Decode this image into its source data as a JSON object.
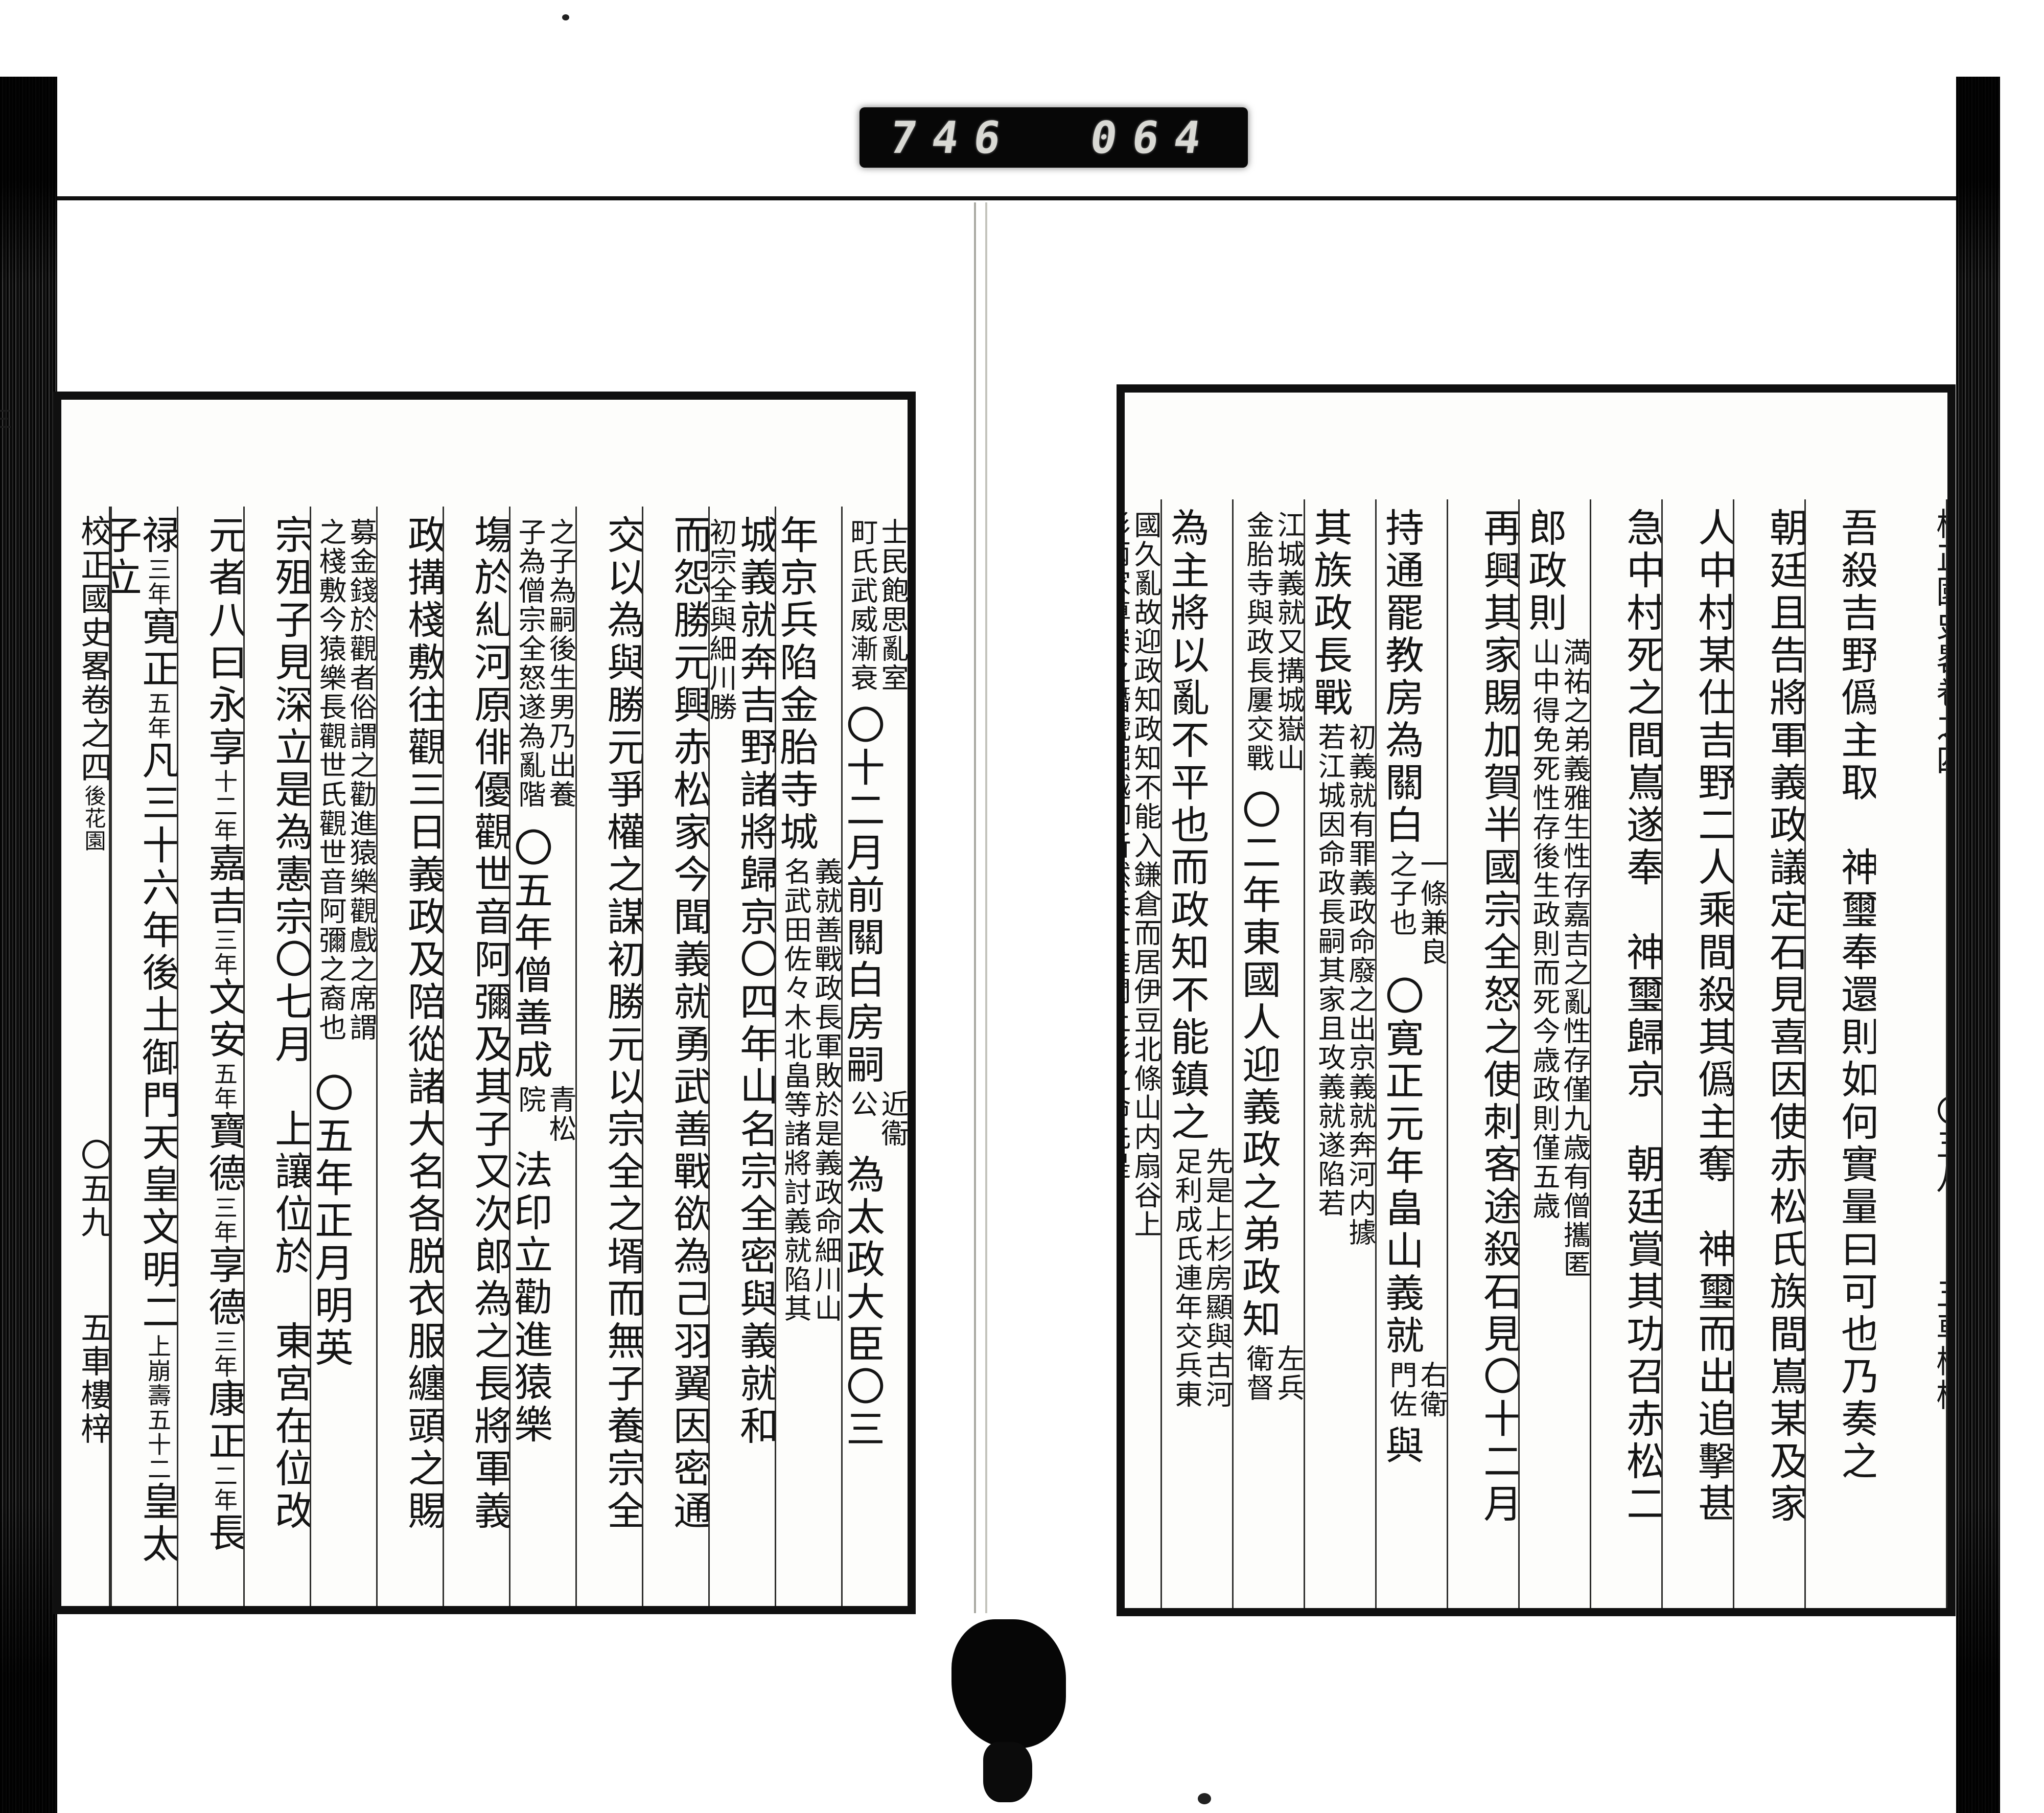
{
  "scanner_counter": {
    "left_digits": "746",
    "right_digits": "064"
  },
  "book_title": "校正國史畧卷之四",
  "right_page": {
    "headers": [
      {
        "lines": [
          "赤松氏",
          "家至是",
          "可興"
        ],
        "offset": 620
      },
      {
        "lines": [
          "寛正元",
          "年"
        ],
        "offset": 990
      },
      {
        "lines": [
          "二",
          "年"
        ],
        "offset": 1300
      }
    ],
    "columns": [
      {
        "gutter": true,
        "clipped": true,
        "segments": [
          {
            "type": "main",
            "text": "校正國史畧卷之四"
          },
          {
            "type": "gap",
            "px": 620
          },
          {
            "type": "main",
            "text": "〇五八"
          },
          {
            "type": "gap",
            "px": 160
          },
          {
            "type": "main",
            "text": "五車樓梓"
          }
        ]
      },
      {
        "segments": [
          {
            "type": "main",
            "text": "吾殺吉野僞主取　神璽奉還則如何實量曰可也乃奏之"
          }
        ]
      },
      {
        "segments": [
          {
            "type": "main",
            "text": "朝廷且告將軍義政議定石見喜因使赤松氏族間嶌某及家"
          }
        ]
      },
      {
        "segments": [
          {
            "type": "main",
            "text": "人中村某仕吉野二人乘間殺其僞主奪　神璽而出追擊甚"
          }
        ]
      },
      {
        "segments": [
          {
            "type": "main",
            "text": "急中村死之間嶌遂奉　神璽歸京　朝廷賞其功召赤松二"
          }
        ]
      },
      {
        "segments": [
          {
            "type": "main",
            "text": "郎政則"
          },
          {
            "type": "note",
            "text": "満祐之弟義雅生性存嘉吉之亂性存僅九歳有僧攜匿山中得免死性存後生政則而死今歳政則僅五歳"
          }
        ]
      },
      {
        "segments": [
          {
            "type": "main",
            "text": "再興其家賜加賀半國宗全怒之使刺客途殺石見〇十二月"
          }
        ]
      },
      {
        "segments": [
          {
            "type": "main",
            "text": "持通罷教房為關白"
          },
          {
            "type": "note",
            "text": "一條兼良之子也"
          },
          {
            "type": "main",
            "text": "〇寛正元年畠山義就"
          },
          {
            "type": "note",
            "text": "右衛門佐"
          },
          {
            "type": "main",
            "text": "與"
          }
        ]
      },
      {
        "segments": [
          {
            "type": "main",
            "text": "其族政長戰"
          },
          {
            "type": "note",
            "text": "初義就有罪義政命廢之出京義就奔河内據若江城因命政長嗣其家且攻義就遂陷若"
          }
        ]
      },
      {
        "segments": [
          {
            "type": "note",
            "text": "江城義就又搆城嶽山金胎寺與政長屢交戰"
          },
          {
            "type": "main",
            "text": "〇二年東國人迎義政之弟政知"
          },
          {
            "type": "note",
            "text": "左兵衛督"
          }
        ]
      },
      {
        "segments": [
          {
            "type": "main",
            "text": "為主將以亂不平也而政知不能鎮之"
          },
          {
            "type": "note",
            "text": "先是上杉房顯與古河足利成氏連年交兵東"
          }
        ]
      },
      {
        "segments": [
          {
            "type": "note",
            "text": "國久亂故迎政知政知不能入鎌倉而居伊豆北條山内扇谷上杉兩家尊崇之僭號堀越御所然兵士唯聞上杉之命先是"
          }
        ]
      }
    ]
  },
  "left_page": {
    "headers": [
      {
        "lines": [
          "三",
          "年"
        ],
        "offset": 96
      },
      {
        "lines": [
          "四",
          "年"
        ],
        "offset": 366
      },
      {
        "lines": [
          "五",
          "年"
        ],
        "offset": 712
      },
      {
        "lines": [
          "義政觀",
          "猿樂"
        ],
        "offset": 896
      }
    ],
    "columns": [
      {
        "segments": [
          {
            "type": "note",
            "text": "士民飽思亂室町氏武威漸衰"
          },
          {
            "type": "main",
            "text": "〇十二月前關白房嗣"
          },
          {
            "type": "note",
            "text": "近衞公"
          },
          {
            "type": "main",
            "text": "為太政大臣〇三"
          }
        ]
      },
      {
        "segments": [
          {
            "type": "main",
            "text": "年京兵陷金胎寺城"
          },
          {
            "type": "note",
            "text": "義就善戰政長軍敗於是義政命細川山名武田佐々木北畠等諸將討義就陷其"
          }
        ]
      },
      {
        "segments": [
          {
            "type": "main",
            "text": "城義就奔吉野諸將歸京〇四年山名宗全密與義就和"
          },
          {
            "type": "note",
            "text": "初宗全與細川勝元逐義就援政長"
          }
        ]
      },
      {
        "segments": [
          {
            "type": "main",
            "text": "而怨勝元興赤松家今聞義就勇武善戰欲為己羽翼因密通"
          }
        ]
      },
      {
        "segments": [
          {
            "type": "main",
            "text": "交以為與勝元爭權之謀初勝元以宗全之壻而無子養宗全"
          }
        ]
      },
      {
        "segments": [
          {
            "type": "note",
            "text": "之子為嗣後生男乃出養子為僧宗全怒遂為亂階"
          },
          {
            "type": "main",
            "text": "〇五年僧善成"
          },
          {
            "type": "note",
            "text": "青松院"
          },
          {
            "type": "main",
            "text": "法印立勸進猿樂"
          }
        ]
      },
      {
        "segments": [
          {
            "type": "main",
            "text": "塲於糺河原俳優觀世音阿彌及其子又次郎為之長將軍義"
          }
        ]
      },
      {
        "segments": [
          {
            "type": "main",
            "text": "政搆棧敷往觀三日義政及陪從諸大名各脱衣服纏頭之賜"
          }
        ]
      },
      {
        "segments": [
          {
            "type": "note",
            "text": "募金錢於觀者俗謂之勸進猿樂觀戲之席謂之棧敷今猿樂長觀世氏觀世音阿彌之裔也"
          },
          {
            "type": "main",
            "text": "〇五年正月明英"
          }
        ]
      },
      {
        "segments": [
          {
            "type": "main",
            "text": "宗殂子見深立是為憲宗〇七月　上讓位於　東宮在位改"
          }
        ]
      },
      {
        "segments": [
          {
            "type": "main",
            "text": "元者八曰永享"
          },
          {
            "type": "small",
            "text": "十二年"
          },
          {
            "type": "main",
            "text": "嘉吉"
          },
          {
            "type": "small",
            "text": "三年"
          },
          {
            "type": "main",
            "text": "文安"
          },
          {
            "type": "small",
            "text": "五年"
          },
          {
            "type": "main",
            "text": "寶德"
          },
          {
            "type": "small",
            "text": "三年"
          },
          {
            "type": "main",
            "text": "享德"
          },
          {
            "type": "small",
            "text": "三年"
          },
          {
            "type": "main",
            "text": "康正"
          },
          {
            "type": "small",
            "text": "二年"
          },
          {
            "type": "main",
            "text": "長"
          }
        ]
      },
      {
        "segments": [
          {
            "type": "main",
            "text": "禄"
          },
          {
            "type": "small",
            "text": "三年"
          },
          {
            "type": "main",
            "text": "寛正"
          },
          {
            "type": "small",
            "text": "五年"
          },
          {
            "type": "main",
            "text": "凡三十六年後土御門天皇文明二"
          },
          {
            "type": "small",
            "text": "上崩壽五十二"
          },
          {
            "type": "main",
            "text": "皇太子立"
          }
        ]
      },
      {
        "gutter": true,
        "segments": [
          {
            "type": "main",
            "text": "校正國史畧卷之四"
          },
          {
            "type": "small",
            "text": "後花園"
          },
          {
            "type": "gap",
            "px": 560
          },
          {
            "type": "main",
            "text": "〇五九"
          },
          {
            "type": "gap",
            "px": 140
          },
          {
            "type": "main",
            "text": "五車樓梓"
          }
        ]
      }
    ]
  }
}
